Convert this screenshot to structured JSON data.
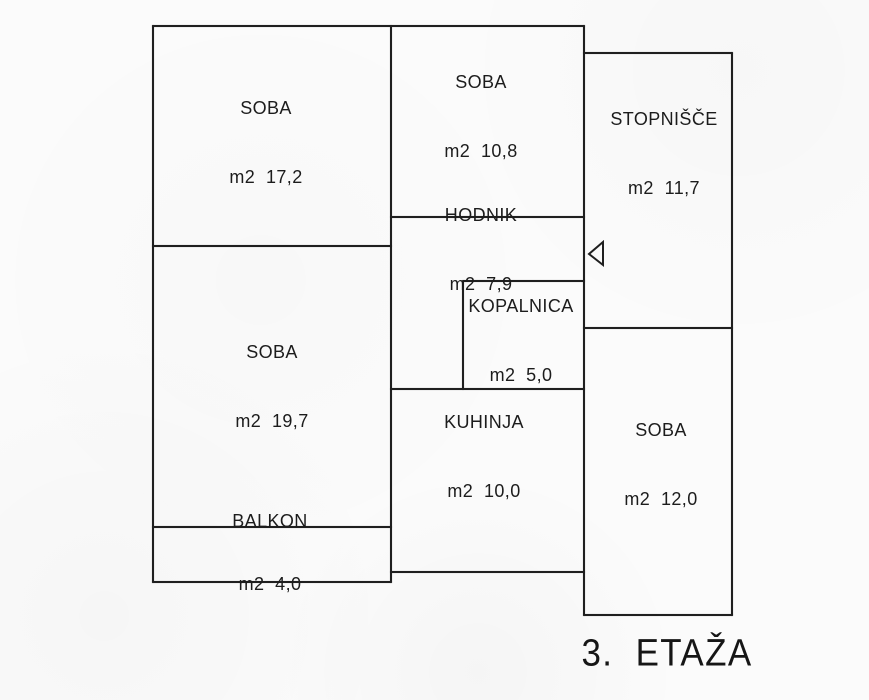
{
  "floorplan": {
    "floor_label": "3.  ETAŽA",
    "rooms": {
      "soba_17": {
        "name": "SOBA",
        "area": "m2  17,2"
      },
      "soba_10": {
        "name": "SOBA",
        "area": "m2  10,8"
      },
      "stopnisce": {
        "name": "STOPNIŠČE",
        "area": "m2  11,7"
      },
      "hodnik": {
        "name": "HODNIK",
        "area": "m2  7,9"
      },
      "kopalnica": {
        "name": "KOPALNICA",
        "area": "m2  5,0"
      },
      "soba_19": {
        "name": "SOBA",
        "area": "m2  19,7"
      },
      "kuhinja": {
        "name": "KUHINJA",
        "area": "m2  10,0"
      },
      "soba_12": {
        "name": "SOBA",
        "area": "m2  12,0"
      },
      "balkon": {
        "name": "BALKON",
        "area": "m2  4,0"
      }
    },
    "icons": {
      "entrance_arrow": "left-pointing-triangle-door-marker"
    },
    "colors": {
      "wall": "#1f1f1f",
      "background": "#fbfbfb",
      "text": "#1a1a1a"
    }
  }
}
